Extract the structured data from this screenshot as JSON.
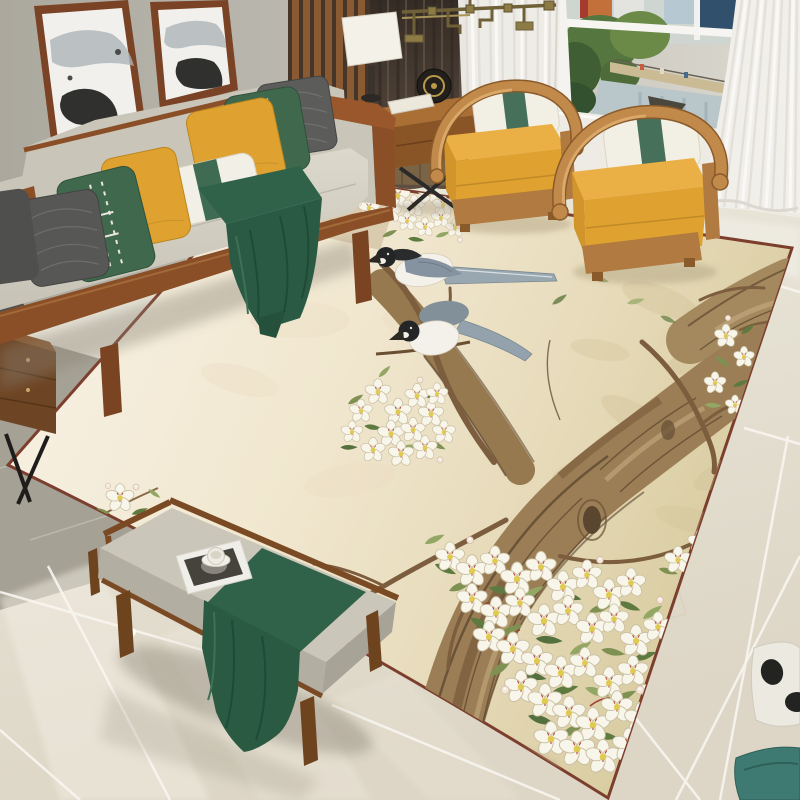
{
  "meta": {
    "type": "product-photo",
    "description": "Top-down photograph of a chinoiserie blossom-and-magpie area rug styled in a modern Chinese living room; no on-screen UI text."
  },
  "labels": {
    "scene": "Modern Chinese living room with blossom-and-magpie area rug",
    "chandelier": "Brass fretwork chandelier",
    "wall_art_left": "Ink-wash mountain artwork in wood frame (left)",
    "wall_art_right": "Ink-wash mountain artwork in wood frame (right)",
    "slat_panel": "Walnut slat accent wall panel",
    "curtain_dark": "Dark brown blackout curtain",
    "sheer_middle": "White sheer curtain (middle)",
    "sheer_right": "White sheer curtain at window",
    "window": "Window with canal-park city view",
    "sofa": "Light gray wood-trim sofa",
    "pillows": "Accent pillows: charcoal, embroidered green, mustard, white-green lumbar",
    "throw": "Dark green throw blanket",
    "side_table": "Wood side table with black X legs",
    "lamp": "Cream drum table lamp",
    "decor_disc": "Round black decorative disc",
    "books": "Stacked white books",
    "armchair_near": "Mustard horseshoe-back armchair (near)",
    "armchair_far": "Mustard horseshoe-back armchair (far)",
    "chair_pillow": "White lumbar pillow with green center band",
    "rug": "Chinoiserie rug: blossoming tree with magpies on cream-to-tan ground, maroon edge trim",
    "rug_tree": "Gnarled blossoming tree trunk and branches",
    "rug_birds": "Pair of long-tailed magpies",
    "rug_blossoms": "White pear blossoms, buds and green leaves",
    "rug_sprig": "Single blossom sprig at rug corner",
    "bench": "Walnut bench with gray cushion",
    "bench_runner": "Dark green bench runner",
    "magazine": "Magazine with black-and-white cover",
    "teacup": "White cup and saucer",
    "floor_marble": "Polished marble tile floor",
    "floor_gray": "Matte gray tile floor",
    "cabinet": "Walnut side cabinet with metal legs",
    "ornament": "Black-and-white ornament at right edge",
    "floor_cushion": "Teal floor cushion at bottom-right"
  },
  "palette": {
    "wall": "#b3b0a6",
    "sofa_fabric": "#d8d4c8",
    "sofa_wood": "#8a4f27",
    "pillow_yellow": "#dfa231",
    "pillow_green": "#40684d",
    "pillow_gray": "#5c5c5a",
    "lumbar_white": "#f2efe6",
    "throw_green": "#2a5a44",
    "chair_wood": "#c28a4a",
    "chair_cushion": "#e2a93c",
    "curtain_dark": "#4a3e33",
    "sheer_white": "#f0eee9",
    "rug_cream": "#f6efe0",
    "rug_tan": "#d6c99c",
    "rug_trim": "#7c3f2e",
    "trunk_brown": "#9b7e55",
    "leaf_green": "#6f8449",
    "blossom_white": "#f8f5ea",
    "bird_black": "#242526",
    "bird_gray": "#93a2ac",
    "marble": "#e7e2d7",
    "gray_tile": "#a6a195",
    "brass": "#8d7b46",
    "bench_wood": "#7a4a24",
    "runner_green": "#2f6249",
    "window_water": "#b9c6ca"
  }
}
